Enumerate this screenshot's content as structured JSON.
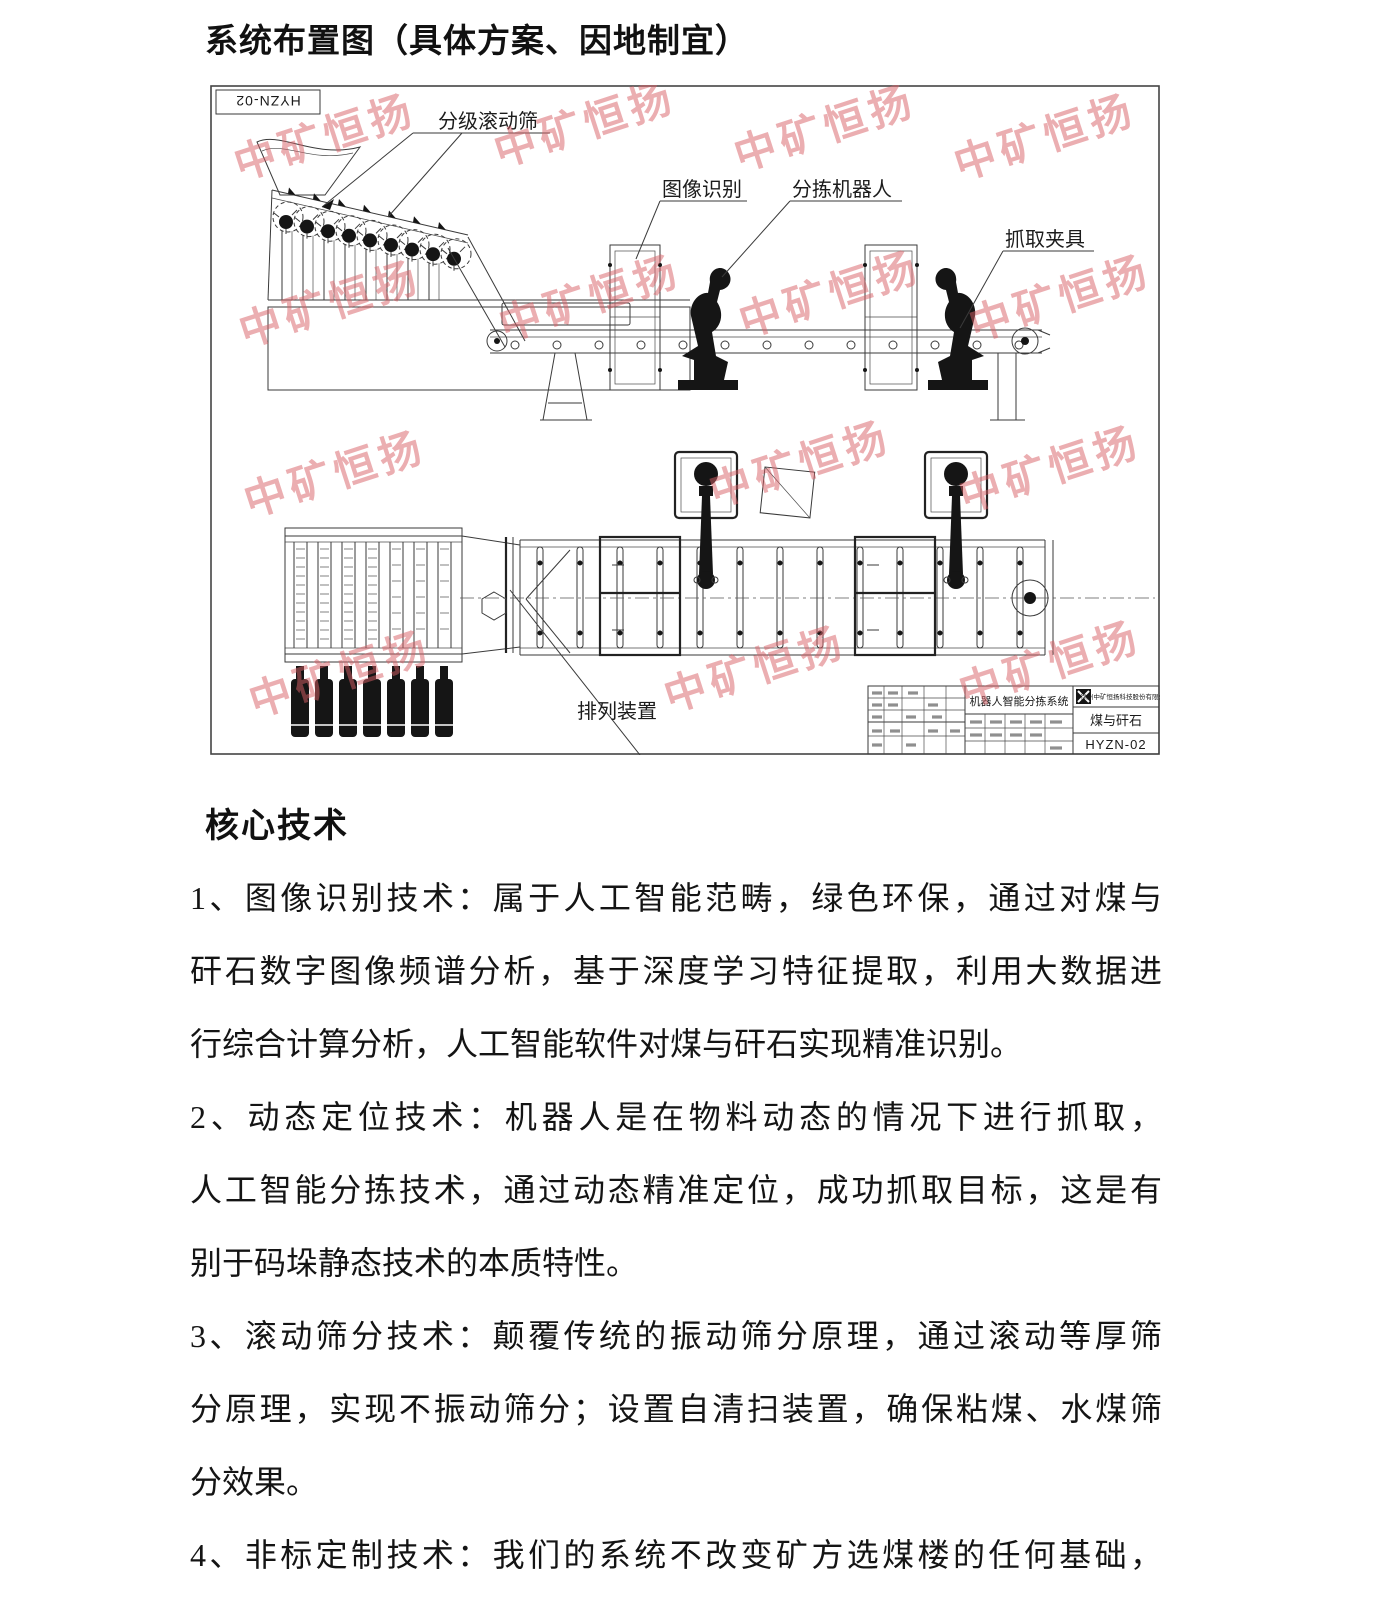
{
  "document": {
    "title": "系统布置图（具体方案、因地制宜）",
    "section_heading": "核心技术",
    "body_lines": [
      "1、图像识别技术：属于人工智能范畴，绿色环保，通过对煤与",
      "矸石数字图像频谱分析，基于深度学习特征提取，利用大数据进",
      "行综合计算分析，人工智能软件对煤与矸石实现精准识别。",
      "2、动态定位技术：机器人是在物料动态的情况下进行抓取，",
      "人工智能分拣技术，通过动态精准定位，成功抓取目标，这是有",
      "别于码垛静态技术的本质特性。",
      "3、滚动筛分技术：颠覆传统的振动筛分原理，通过滚动等厚筛",
      "分原理，实现不振动筛分；设置自清扫装置，确保粘煤、水煤筛",
      "分效果。",
      "4、非标定制技术：我们的系统不改变矿方选煤楼的任何基础，"
    ]
  },
  "drawing": {
    "corner_code": "HYZN-02",
    "watermark_text": "中矿恒扬",
    "watermark_color": "#d95f66",
    "labels": {
      "grading_roller_screen": "分级滚动筛",
      "image_recognition": "图像识别",
      "sorting_robot": "分拣机器人",
      "gripper": "抓取夹具",
      "arranging_device": "排列装置"
    },
    "title_block": {
      "project": "机器人智能分拣系统",
      "company": "徐州中矿恒扬科技股份有限公司",
      "product": "煤与矸石",
      "drawing_no": "HYZN-02"
    }
  }
}
